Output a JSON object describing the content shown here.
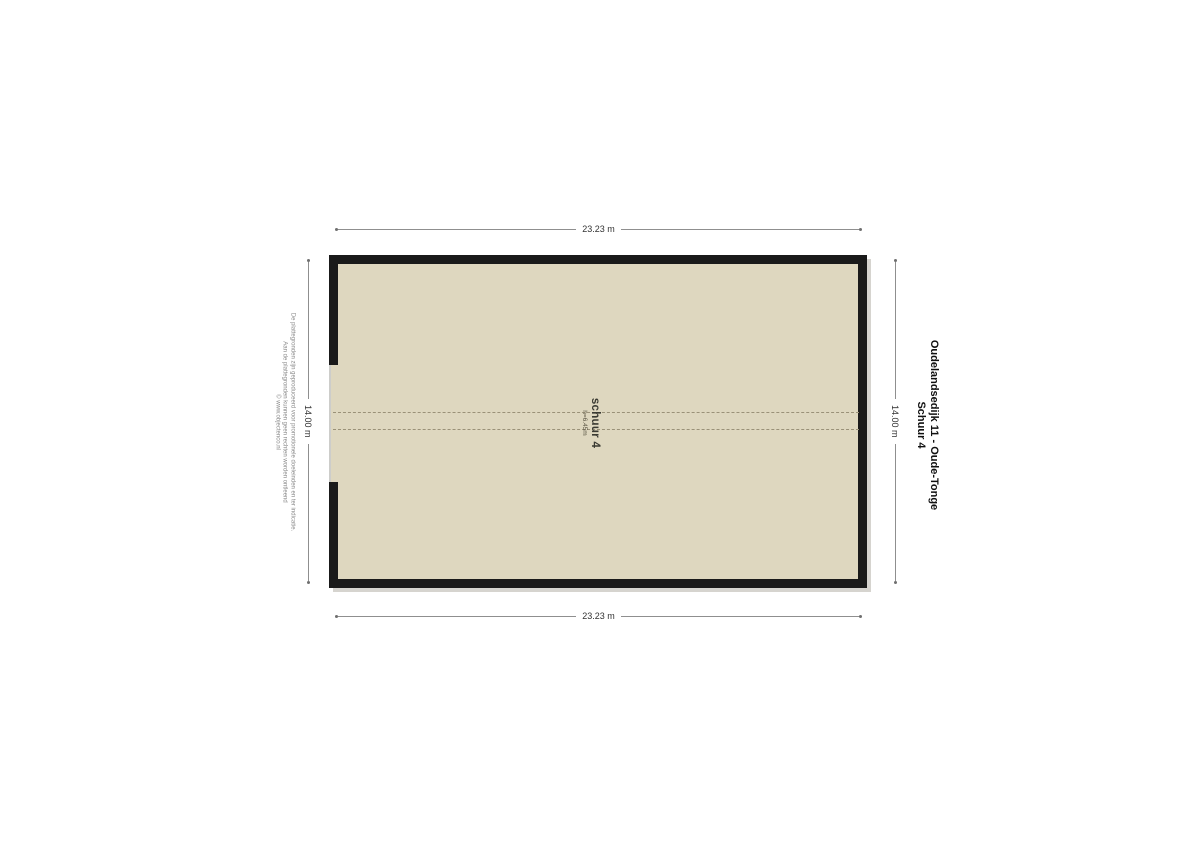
{
  "plan": {
    "room": {
      "label": "schuur 4",
      "height_note": "h=6.45m"
    },
    "dimensions": {
      "top": "23.23 m",
      "bottom": "23.23 m",
      "left": "14.00 m",
      "right": "14.00 m"
    }
  },
  "title": {
    "line1": "Oudelandsedijk 11 - Oude-Tonge",
    "line2": "Schuur 4"
  },
  "disclaimer": {
    "line1": "De plattegronden zijn geproduceerd voor promotionele doeleinden en ter indicatie.",
    "line2": "Aan de plattegronden kunnen geen rechten worden ontleend",
    "line3": "© www.objectenco.nl"
  },
  "colors": {
    "floor_fill": "#ded7bf",
    "wall": "#1a1a1a",
    "dashed_line": "#9a9178",
    "dimension_line": "#8f8f8f",
    "text": "#111111",
    "disclaimer_text": "#8a8a8a",
    "background": "#ffffff"
  }
}
